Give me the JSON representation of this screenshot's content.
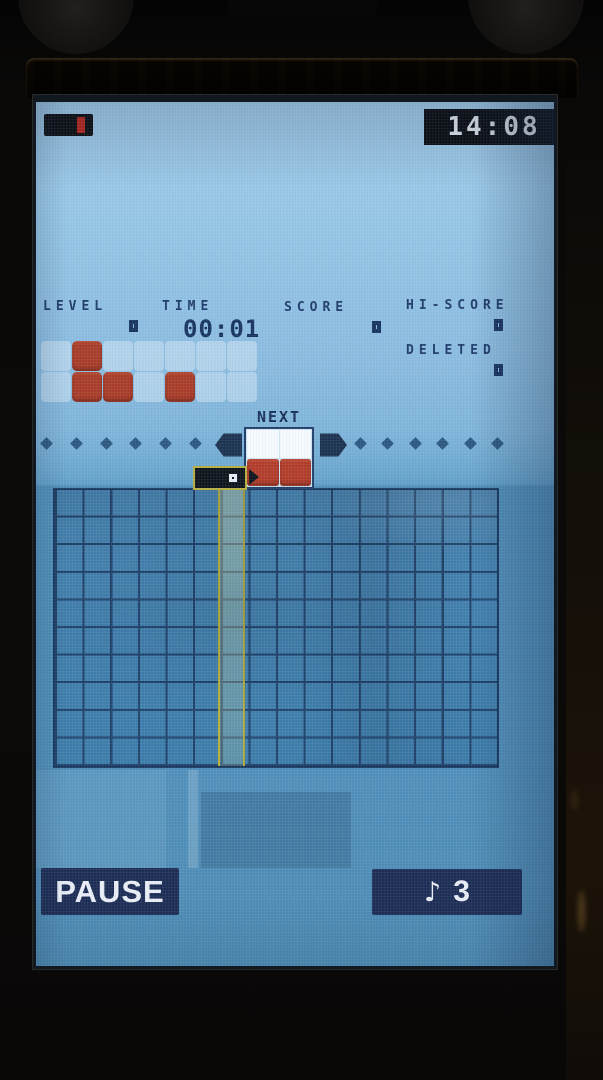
{
  "device": {
    "clock": "14:08",
    "battery": {
      "icon": "battery-low-icon",
      "level_color": "#b5251d"
    }
  },
  "hud": {
    "level": {
      "label": "LEVEL",
      "value": "0"
    },
    "time": {
      "label": "TIME",
      "value": "00:01"
    },
    "score": {
      "label": "SCORE",
      "value": "0"
    },
    "hi_score": {
      "label": "HI-SCORE",
      "value": "0"
    },
    "deleted": {
      "label": "DELETED",
      "value": "0"
    }
  },
  "level_pattern": {
    "rows": 2,
    "cols": 7,
    "cells": [
      [
        "W",
        "R",
        "W",
        "W",
        "W",
        "W",
        "W"
      ],
      [
        "W",
        "R",
        "R",
        "W",
        "R",
        "W",
        "W"
      ]
    ]
  },
  "timeline": {
    "left_markers": 6,
    "right_markers": 6,
    "marker_icon": "diamond-icon"
  },
  "next": {
    "label": "NEXT",
    "grid": [
      [
        "W",
        "W"
      ],
      [
        "R",
        "R"
      ]
    ]
  },
  "field": {
    "cols": 16,
    "rows": 10,
    "active_column": 7,
    "falling_piece": {
      "cells": [
        "solid",
        "special"
      ],
      "outline_color": "#b6ae3e"
    }
  },
  "footer": {
    "pause_label": "PAUSE",
    "music_icon": "♪",
    "music_value": "3"
  },
  "colors": {
    "block_red": "#a83b26",
    "ui_navy": "#16325e",
    "field_blue": "#4080ae",
    "grid_line": "#1d4068",
    "highlight_yellow": "#b6b03a",
    "screen_blue": "#8fc0e0"
  }
}
